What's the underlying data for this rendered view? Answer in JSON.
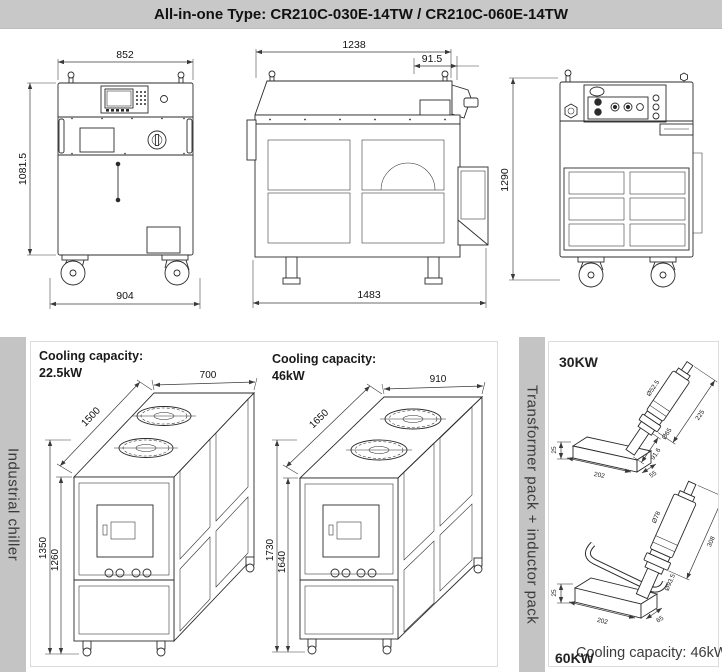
{
  "header": {
    "title": "All-in-one Type: CR210C-030E-14TW / CR210C-060E-14TW"
  },
  "colors": {
    "header_bg": "#c8c8c8",
    "sidebar_bg": "#c4c4c4",
    "line": "#2b2b2b",
    "panel_bg": "#ffffff"
  },
  "front_view": {
    "width_top": "852",
    "height_left": "1081.5",
    "width_bottom": "904"
  },
  "side_view": {
    "width_top": "1238",
    "duct_offset": "91.5",
    "width_bottom": "1483"
  },
  "rear_view": {
    "height_left": "1290"
  },
  "chiller_panel": {
    "sidebar_label": "Industrial chiller",
    "small": {
      "capacity_label": "Cooling capacity:",
      "capacity_value": "22.5kW",
      "width_top": "700",
      "depth": "1500",
      "height_total": "1350",
      "height_body": "1260"
    },
    "large": {
      "capacity_label": "Cooling capacity:",
      "capacity_value": "46kW",
      "width_top": "910",
      "depth": "1650",
      "height_total": "1730",
      "height_body": "1640"
    }
  },
  "inductor_panel": {
    "sidebar_label": "Transformer pack + inductor pack",
    "pack30": {
      "label": "30KW",
      "dia_body": "Ø52.5",
      "len_body": "225",
      "dia_flange": "Ø65",
      "len_shaft": "91.6",
      "base_len": "202",
      "base_wid": "55",
      "base_h": "25"
    },
    "pack60": {
      "label": "60KW",
      "dia_body": "Ø78",
      "dia_flange": "Ø93.5",
      "len_body": "308",
      "base_len": "202",
      "base_wid": "65",
      "base_h": "25"
    },
    "caption": "Cooling capacity: 46kW"
  }
}
